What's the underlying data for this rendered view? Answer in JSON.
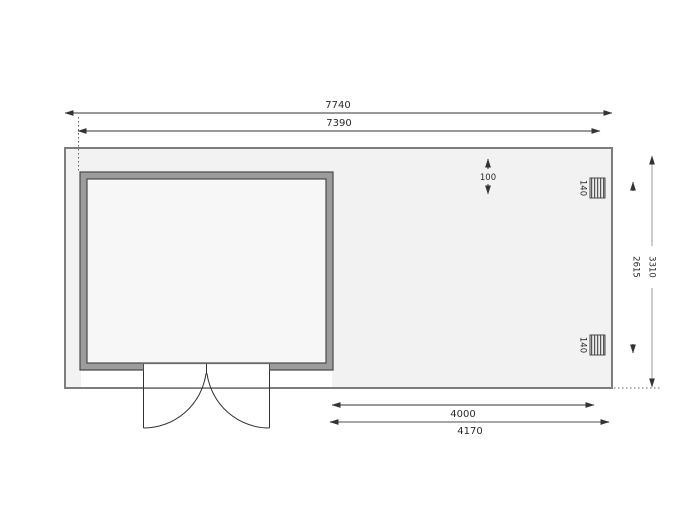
{
  "plan": {
    "dim_total_width": "7740",
    "dim_wall_length": "7390",
    "dim_roof_overhang": "100",
    "dim_post_top_size": "140",
    "dim_post_bottom_size": "140",
    "dim_post_spacing": "2615",
    "dim_total_depth": "3310",
    "dim_canopy_clear": "4000",
    "dim_canopy_total": "4170"
  },
  "colors": {
    "floor_fill": "#f2f2f2",
    "room_fill": "#f7f7f7",
    "wall_fill": "#9c9c9c",
    "outline_dark": "#4a4a4a",
    "dim_line_dark": "#333333",
    "dim_line_gray": "#8a8a8a"
  }
}
